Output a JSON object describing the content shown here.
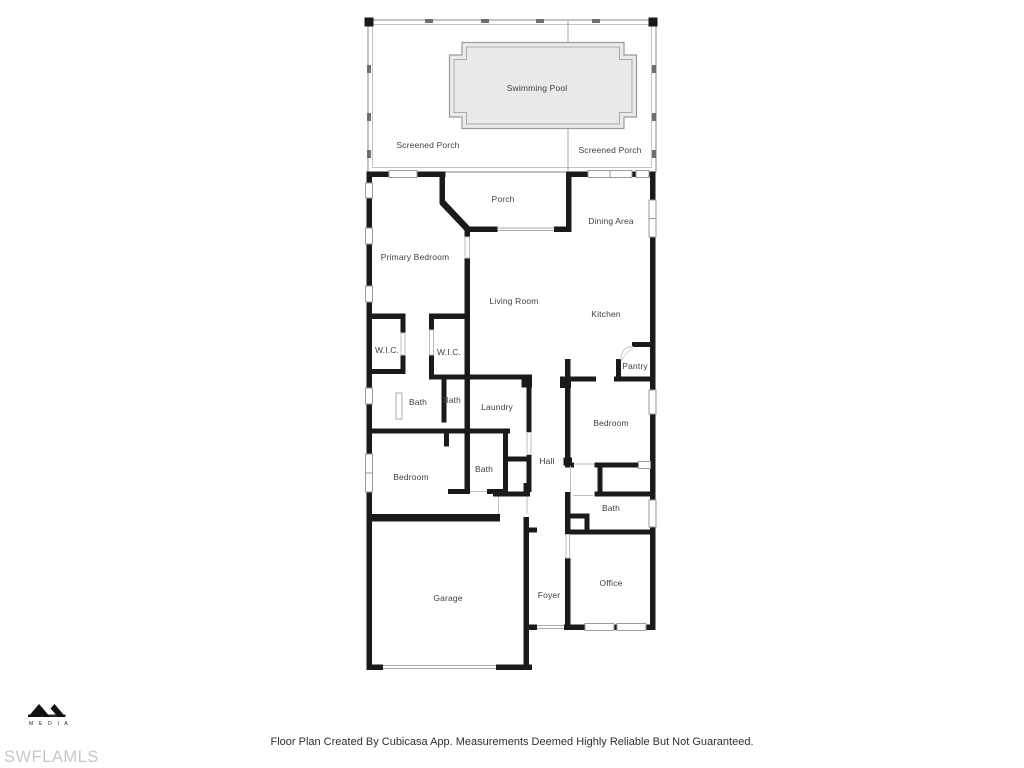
{
  "plan": {
    "rooms": [
      {
        "id": "swimming-pool",
        "label": "Swimming Pool"
      },
      {
        "id": "screened-porch-left",
        "label": "Screened Porch"
      },
      {
        "id": "screened-porch-right",
        "label": "Screened Porch"
      },
      {
        "id": "porch",
        "label": "Porch"
      },
      {
        "id": "dining-area",
        "label": "Dining Area"
      },
      {
        "id": "primary-bedroom",
        "label": "Primary Bedroom"
      },
      {
        "id": "living-room",
        "label": "Living Room"
      },
      {
        "id": "kitchen",
        "label": "Kitchen"
      },
      {
        "id": "wic-left",
        "label": "W.I.C."
      },
      {
        "id": "wic-right",
        "label": "W.I.C."
      },
      {
        "id": "pantry",
        "label": "Pantry"
      },
      {
        "id": "bath-primary-left",
        "label": "Bath"
      },
      {
        "id": "bath-primary-right",
        "label": "Bath"
      },
      {
        "id": "laundry",
        "label": "Laundry"
      },
      {
        "id": "bedroom-right",
        "label": "Bedroom"
      },
      {
        "id": "hall",
        "label": "Hall"
      },
      {
        "id": "bath-center",
        "label": "Bath"
      },
      {
        "id": "bedroom-left",
        "label": "Bedroom"
      },
      {
        "id": "bath-right",
        "label": "Bath"
      },
      {
        "id": "office",
        "label": "Office"
      },
      {
        "id": "foyer",
        "label": "Foyer"
      },
      {
        "id": "garage",
        "label": "Garage"
      }
    ],
    "footer": "Floor Plan Created By Cubicasa App. Measurements Deemed Highly Reliable But Not Guaranteed.",
    "watermark": "SWFLAMLS",
    "logo": {
      "text": "M E D I A"
    }
  },
  "colors": {
    "wall": "#1a1a1a",
    "pool_fill": "#ebebeb",
    "outline_gray": "#9a9a9a",
    "label_text": "#3f3f3f",
    "watermark_gray": "#c7c7c7"
  }
}
